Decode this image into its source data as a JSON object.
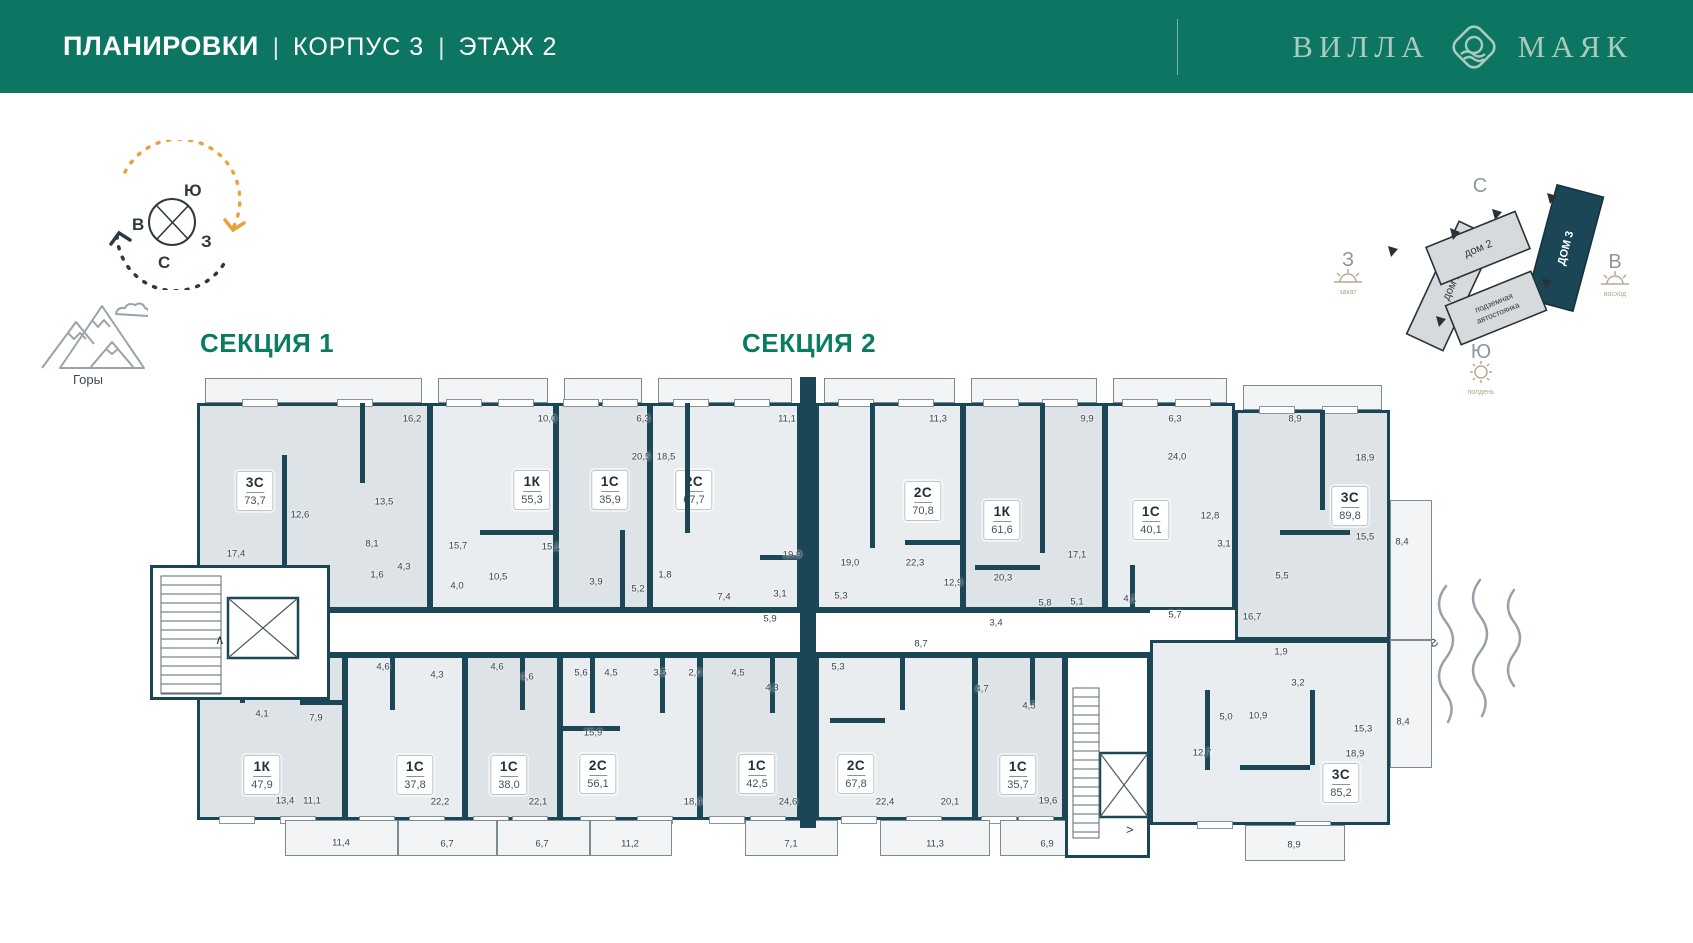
{
  "header": {
    "title": "ПЛАНИРОВКИ",
    "sep1": "|",
    "subtitle1": "КОРПУС 3",
    "sep2": "|",
    "subtitle2": "ЭТАЖ 2",
    "brand": {
      "word1": "ВИЛЛА",
      "word2": "МАЯК"
    }
  },
  "compass": {
    "top": "Ю",
    "left": "В",
    "right": "З",
    "bottom": "С"
  },
  "legend": {
    "mountains": "Горы",
    "sea": "Море"
  },
  "minimap": {
    "north": "С",
    "west": {
      "label": "З",
      "sub": "закат"
    },
    "south": {
      "label": "Ю",
      "sub": "полдень"
    },
    "east": {
      "label": "В",
      "sub": "восход"
    },
    "buildings": [
      {
        "name": "дом 1"
      },
      {
        "name": "дом 2"
      },
      {
        "name": "ДОМ 3"
      },
      {
        "name1": "подземная",
        "name2": "автостоянка"
      }
    ]
  },
  "sections": [
    {
      "label": "СЕКЦИЯ 1",
      "x": 200,
      "y": 328
    },
    {
      "label": "СЕКЦИЯ 2",
      "x": 742,
      "y": 328
    }
  ],
  "plan": {
    "wall_color": "#1b4655",
    "units": [
      {
        "type": "3С",
        "area": "73,7",
        "x": 197,
        "y": 403,
        "w": 233,
        "h": 207,
        "fill": "#dde3e7",
        "cx": 255,
        "cy": 491
      },
      {
        "type": "1К",
        "area": "55,3",
        "x": 430,
        "y": 403,
        "w": 126,
        "h": 207,
        "fill": "#e9edf0",
        "cx": 532,
        "cy": 490
      },
      {
        "type": "1С",
        "area": "35,9",
        "x": 556,
        "y": 403,
        "w": 94,
        "h": 207,
        "fill": "#dde3e7",
        "cx": 610,
        "cy": 490
      },
      {
        "type": "2С",
        "area": "67,7",
        "x": 650,
        "y": 403,
        "w": 150,
        "h": 207,
        "fill": "#e9edf0",
        "cx": 694,
        "cy": 490
      },
      {
        "type": "2С",
        "area": "70,8",
        "x": 816,
        "y": 403,
        "w": 147,
        "h": 207,
        "fill": "#e9edf0",
        "cx": 923,
        "cy": 501
      },
      {
        "type": "1К",
        "area": "61,6",
        "x": 963,
        "y": 403,
        "w": 142,
        "h": 207,
        "fill": "#dde3e7",
        "cx": 1002,
        "cy": 520
      },
      {
        "type": "1С",
        "area": "40,1",
        "x": 1105,
        "y": 403,
        "w": 130,
        "h": 207,
        "fill": "#e9edf0",
        "cx": 1151,
        "cy": 520
      },
      {
        "type": "3С",
        "area": "89,8",
        "x": 1235,
        "y": 410,
        "w": 155,
        "h": 230,
        "fill": "#dde3e7",
        "cx": 1350,
        "cy": 506
      },
      {
        "type": "1К",
        "area": "47,9",
        "x": 197,
        "y": 655,
        "w": 148,
        "h": 165,
        "fill": "#dde3e7",
        "cx": 262,
        "cy": 775
      },
      {
        "type": "1С",
        "area": "37,8",
        "x": 345,
        "y": 655,
        "w": 120,
        "h": 165,
        "fill": "#e9edf0",
        "cx": 415,
        "cy": 775
      },
      {
        "type": "1С",
        "area": "38,0",
        "x": 465,
        "y": 655,
        "w": 95,
        "h": 165,
        "fill": "#dde3e7",
        "cx": 509,
        "cy": 775
      },
      {
        "type": "2С",
        "area": "56,1",
        "x": 560,
        "y": 655,
        "w": 140,
        "h": 165,
        "fill": "#e9edf0",
        "cx": 598,
        "cy": 774
      },
      {
        "type": "1С",
        "area": "42,5",
        "x": 700,
        "y": 655,
        "w": 100,
        "h": 165,
        "fill": "#dde3e7",
        "cx": 757,
        "cy": 774
      },
      {
        "type": "2С",
        "area": "67,8",
        "x": 816,
        "y": 655,
        "w": 159,
        "h": 165,
        "fill": "#e9edf0",
        "cx": 856,
        "cy": 774
      },
      {
        "type": "1С",
        "area": "35,7",
        "x": 975,
        "y": 655,
        "w": 90,
        "h": 165,
        "fill": "#dde3e7",
        "cx": 1018,
        "cy": 775
      },
      {
        "type": "3С",
        "area": "85,2",
        "x": 1150,
        "y": 640,
        "w": 240,
        "h": 185,
        "fill": "#e9edf0",
        "cx": 1341,
        "cy": 783
      }
    ],
    "terraces": [
      {
        "x": 1390,
        "y": 500,
        "w": 42,
        "h": 140
      },
      {
        "x": 1390,
        "y": 640,
        "w": 42,
        "h": 128
      }
    ],
    "balconies_bottom": [
      {
        "x": 285,
        "y": 820,
        "w": 113,
        "h": 36
      },
      {
        "x": 398,
        "y": 820,
        "w": 99,
        "h": 36
      },
      {
        "x": 497,
        "y": 820,
        "w": 93,
        "h": 36
      },
      {
        "x": 590,
        "y": 820,
        "w": 82,
        "h": 36
      },
      {
        "x": 745,
        "y": 820,
        "w": 93,
        "h": 36
      },
      {
        "x": 880,
        "y": 820,
        "w": 110,
        "h": 36
      },
      {
        "x": 1000,
        "y": 820,
        "w": 95,
        "h": 36
      },
      {
        "x": 1245,
        "y": 825,
        "w": 100,
        "h": 36
      }
    ],
    "corridor": {
      "x": 330,
      "y": 610,
      "w": 820,
      "h": 45
    },
    "section_wall": {
      "x": 800,
      "y": 377,
      "w": 16,
      "h": 451
    },
    "iwalls": [
      [
        282,
        455,
        5,
        125
      ],
      [
        360,
        403,
        5,
        80
      ],
      [
        480,
        530,
        78,
        5
      ],
      [
        620,
        530,
        5,
        80
      ],
      [
        685,
        403,
        5,
        130
      ],
      [
        760,
        555,
        42,
        5
      ],
      [
        870,
        403,
        5,
        145
      ],
      [
        905,
        540,
        58,
        5
      ],
      [
        1040,
        403,
        5,
        150
      ],
      [
        975,
        565,
        65,
        5
      ],
      [
        1130,
        565,
        5,
        45
      ],
      [
        1280,
        530,
        70,
        5
      ],
      [
        1320,
        410,
        5,
        100
      ],
      [
        240,
        655,
        5,
        48
      ],
      [
        300,
        700,
        45,
        5
      ],
      [
        390,
        655,
        5,
        55
      ],
      [
        520,
        655,
        5,
        55
      ],
      [
        590,
        655,
        5,
        58
      ],
      [
        560,
        726,
        60,
        5
      ],
      [
        660,
        655,
        5,
        58
      ],
      [
        770,
        655,
        5,
        58
      ],
      [
        900,
        655,
        5,
        55
      ],
      [
        830,
        718,
        55,
        5
      ],
      [
        1030,
        655,
        5,
        50
      ],
      [
        1205,
        690,
        5,
        80
      ],
      [
        1240,
        765,
        70,
        5
      ],
      [
        1310,
        690,
        5,
        75
      ]
    ],
    "cores": [
      {
        "x": 150,
        "y": 565,
        "w": 180,
        "h": 135,
        "elevator": {
          "x": 75,
          "y": 30,
          "w": 70,
          "h": 60
        },
        "stairs": {
          "x": 8,
          "y": 8,
          "w": 60,
          "h": 118,
          "step": 9,
          "dir": "h"
        },
        "mark": {
          "t": "∧",
          "x": 62,
          "y": 76
        }
      },
      {
        "x": 1065,
        "y": 655,
        "w": 85,
        "h": 203,
        "elevator": {
          "x": 32,
          "y": 95,
          "w": 48,
          "h": 64
        },
        "stairs": {
          "x": 5,
          "y": 30,
          "w": 26,
          "h": 150,
          "step": 9,
          "dir": "h"
        },
        "mark": {
          "t": ">",
          "x": 58,
          "y": 176
        }
      }
    ],
    "dims": [
      {
        "t": "16,2",
        "x": 412,
        "y": 419
      },
      {
        "t": "10,0",
        "x": 547,
        "y": 419
      },
      {
        "t": "6,3",
        "x": 643,
        "y": 419
      },
      {
        "t": "11,1",
        "x": 787,
        "y": 419
      },
      {
        "t": "11,3",
        "x": 938,
        "y": 419
      },
      {
        "t": "9,9",
        "x": 1087,
        "y": 419
      },
      {
        "t": "6,3",
        "x": 1175,
        "y": 419
      },
      {
        "t": "8,9",
        "x": 1295,
        "y": 419
      },
      {
        "t": "20,5",
        "x": 641,
        "y": 457
      },
      {
        "t": "18,5",
        "x": 666,
        "y": 457
      },
      {
        "t": "24,0",
        "x": 1177,
        "y": 457
      },
      {
        "t": "18,9",
        "x": 1365,
        "y": 458
      },
      {
        "t": "13,5",
        "x": 384,
        "y": 502
      },
      {
        "t": "12,6",
        "x": 300,
        "y": 515
      },
      {
        "t": "8,1",
        "x": 372,
        "y": 544
      },
      {
        "t": "17,4",
        "x": 236,
        "y": 554
      },
      {
        "t": "15,7",
        "x": 458,
        "y": 546
      },
      {
        "t": "15,1",
        "x": 551,
        "y": 547
      },
      {
        "t": "4,3",
        "x": 404,
        "y": 567
      },
      {
        "t": "1,6",
        "x": 377,
        "y": 575
      },
      {
        "t": "4,0",
        "x": 457,
        "y": 586
      },
      {
        "t": "10,5",
        "x": 498,
        "y": 577
      },
      {
        "t": "3,9",
        "x": 596,
        "y": 582
      },
      {
        "t": "5,2",
        "x": 638,
        "y": 589
      },
      {
        "t": "1,8",
        "x": 665,
        "y": 575
      },
      {
        "t": "7,4",
        "x": 724,
        "y": 597
      },
      {
        "t": "3,1",
        "x": 780,
        "y": 594
      },
      {
        "t": "5,9",
        "x": 770,
        "y": 619
      },
      {
        "t": "19,9",
        "x": 792,
        "y": 555
      },
      {
        "t": "19,0",
        "x": 850,
        "y": 563
      },
      {
        "t": "5,3",
        "x": 841,
        "y": 596
      },
      {
        "t": "5,3",
        "x": 838,
        "y": 667
      },
      {
        "t": "8,7",
        "x": 921,
        "y": 644
      },
      {
        "t": "22,3",
        "x": 915,
        "y": 563
      },
      {
        "t": "12,9",
        "x": 953,
        "y": 583
      },
      {
        "t": "20,3",
        "x": 1003,
        "y": 578
      },
      {
        "t": "3,4",
        "x": 996,
        "y": 623
      },
      {
        "t": "5,8",
        "x": 1045,
        "y": 603
      },
      {
        "t": "5,1",
        "x": 1077,
        "y": 602
      },
      {
        "t": "17,1",
        "x": 1077,
        "y": 555
      },
      {
        "t": "4,1",
        "x": 1130,
        "y": 599
      },
      {
        "t": "5,7",
        "x": 1175,
        "y": 615
      },
      {
        "t": "12,8",
        "x": 1210,
        "y": 516
      },
      {
        "t": "3,1",
        "x": 1224,
        "y": 544
      },
      {
        "t": "5,5",
        "x": 1282,
        "y": 576
      },
      {
        "t": "16,7",
        "x": 1252,
        "y": 617
      },
      {
        "t": "1,9",
        "x": 1281,
        "y": 652
      },
      {
        "t": "3,2",
        "x": 1298,
        "y": 683
      },
      {
        "t": "15,5",
        "x": 1365,
        "y": 537
      },
      {
        "t": "8,4",
        "x": 1402,
        "y": 542
      },
      {
        "t": "5,0",
        "x": 1226,
        "y": 717
      },
      {
        "t": "10,9",
        "x": 1258,
        "y": 716
      },
      {
        "t": "12,7",
        "x": 1202,
        "y": 753
      },
      {
        "t": "8,4",
        "x": 1403,
        "y": 722
      },
      {
        "t": "15,3",
        "x": 1363,
        "y": 729
      },
      {
        "t": "18,9",
        "x": 1355,
        "y": 754
      },
      {
        "t": "8,9",
        "x": 1294,
        "y": 845
      },
      {
        "t": "4,1",
        "x": 262,
        "y": 714
      },
      {
        "t": "7,9",
        "x": 316,
        "y": 718
      },
      {
        "t": "13,4",
        "x": 285,
        "y": 801
      },
      {
        "t": "11,1",
        "x": 312,
        "y": 801
      },
      {
        "t": "11,4",
        "x": 341,
        "y": 843
      },
      {
        "t": "4,6",
        "x": 383,
        "y": 667
      },
      {
        "t": "4,3",
        "x": 437,
        "y": 675
      },
      {
        "t": "22,2",
        "x": 440,
        "y": 802
      },
      {
        "t": "6,7",
        "x": 447,
        "y": 844
      },
      {
        "t": "4,6",
        "x": 497,
        "y": 667
      },
      {
        "t": "4,6",
        "x": 527,
        "y": 677
      },
      {
        "t": "22,1",
        "x": 538,
        "y": 802
      },
      {
        "t": "6,7",
        "x": 542,
        "y": 844
      },
      {
        "t": "5,6",
        "x": 581,
        "y": 673
      },
      {
        "t": "4,5",
        "x": 611,
        "y": 673
      },
      {
        "t": "3,5",
        "x": 660,
        "y": 673
      },
      {
        "t": "2,0",
        "x": 695,
        "y": 673
      },
      {
        "t": "4,5",
        "x": 738,
        "y": 673
      },
      {
        "t": "4,3",
        "x": 772,
        "y": 688
      },
      {
        "t": "15,9",
        "x": 593,
        "y": 733
      },
      {
        "t": "18,4",
        "x": 693,
        "y": 802
      },
      {
        "t": "11,2",
        "x": 630,
        "y": 844
      },
      {
        "t": "24,6",
        "x": 788,
        "y": 802
      },
      {
        "t": "7,1",
        "x": 791,
        "y": 844
      },
      {
        "t": "22,4",
        "x": 885,
        "y": 802
      },
      {
        "t": "20,1",
        "x": 950,
        "y": 802
      },
      {
        "t": "11,3",
        "x": 935,
        "y": 844
      },
      {
        "t": "4,7",
        "x": 982,
        "y": 689
      },
      {
        "t": "4,5",
        "x": 1029,
        "y": 706
      },
      {
        "t": "19,6",
        "x": 1048,
        "y": 801
      },
      {
        "t": "6,9",
        "x": 1047,
        "y": 844
      }
    ]
  }
}
